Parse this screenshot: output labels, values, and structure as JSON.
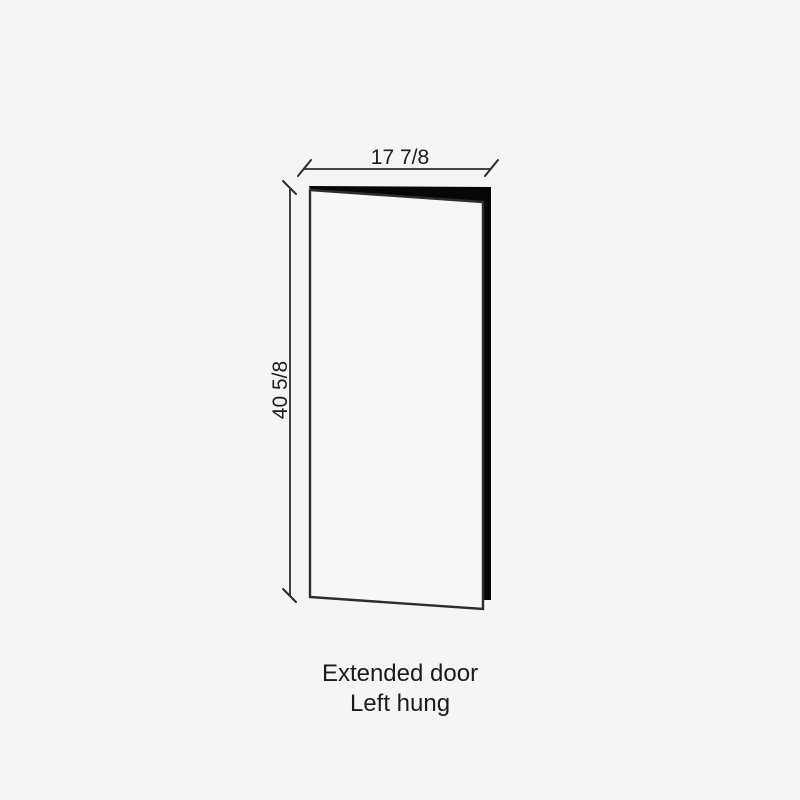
{
  "diagram": {
    "title": "Door elevation diagram",
    "width_dimension": {
      "label": "17 7/8"
    },
    "height_dimension": {
      "label": "40 5/8"
    },
    "caption": {
      "line1": "Extended door",
      "line2": "Left hung"
    }
  },
  "colors": {
    "background": "#f5f5f5",
    "door_face_fill": "#f7f7f7",
    "door_edge_fill": "#070707",
    "outline": "#2d2d2d",
    "text": "#1c1c1c"
  }
}
